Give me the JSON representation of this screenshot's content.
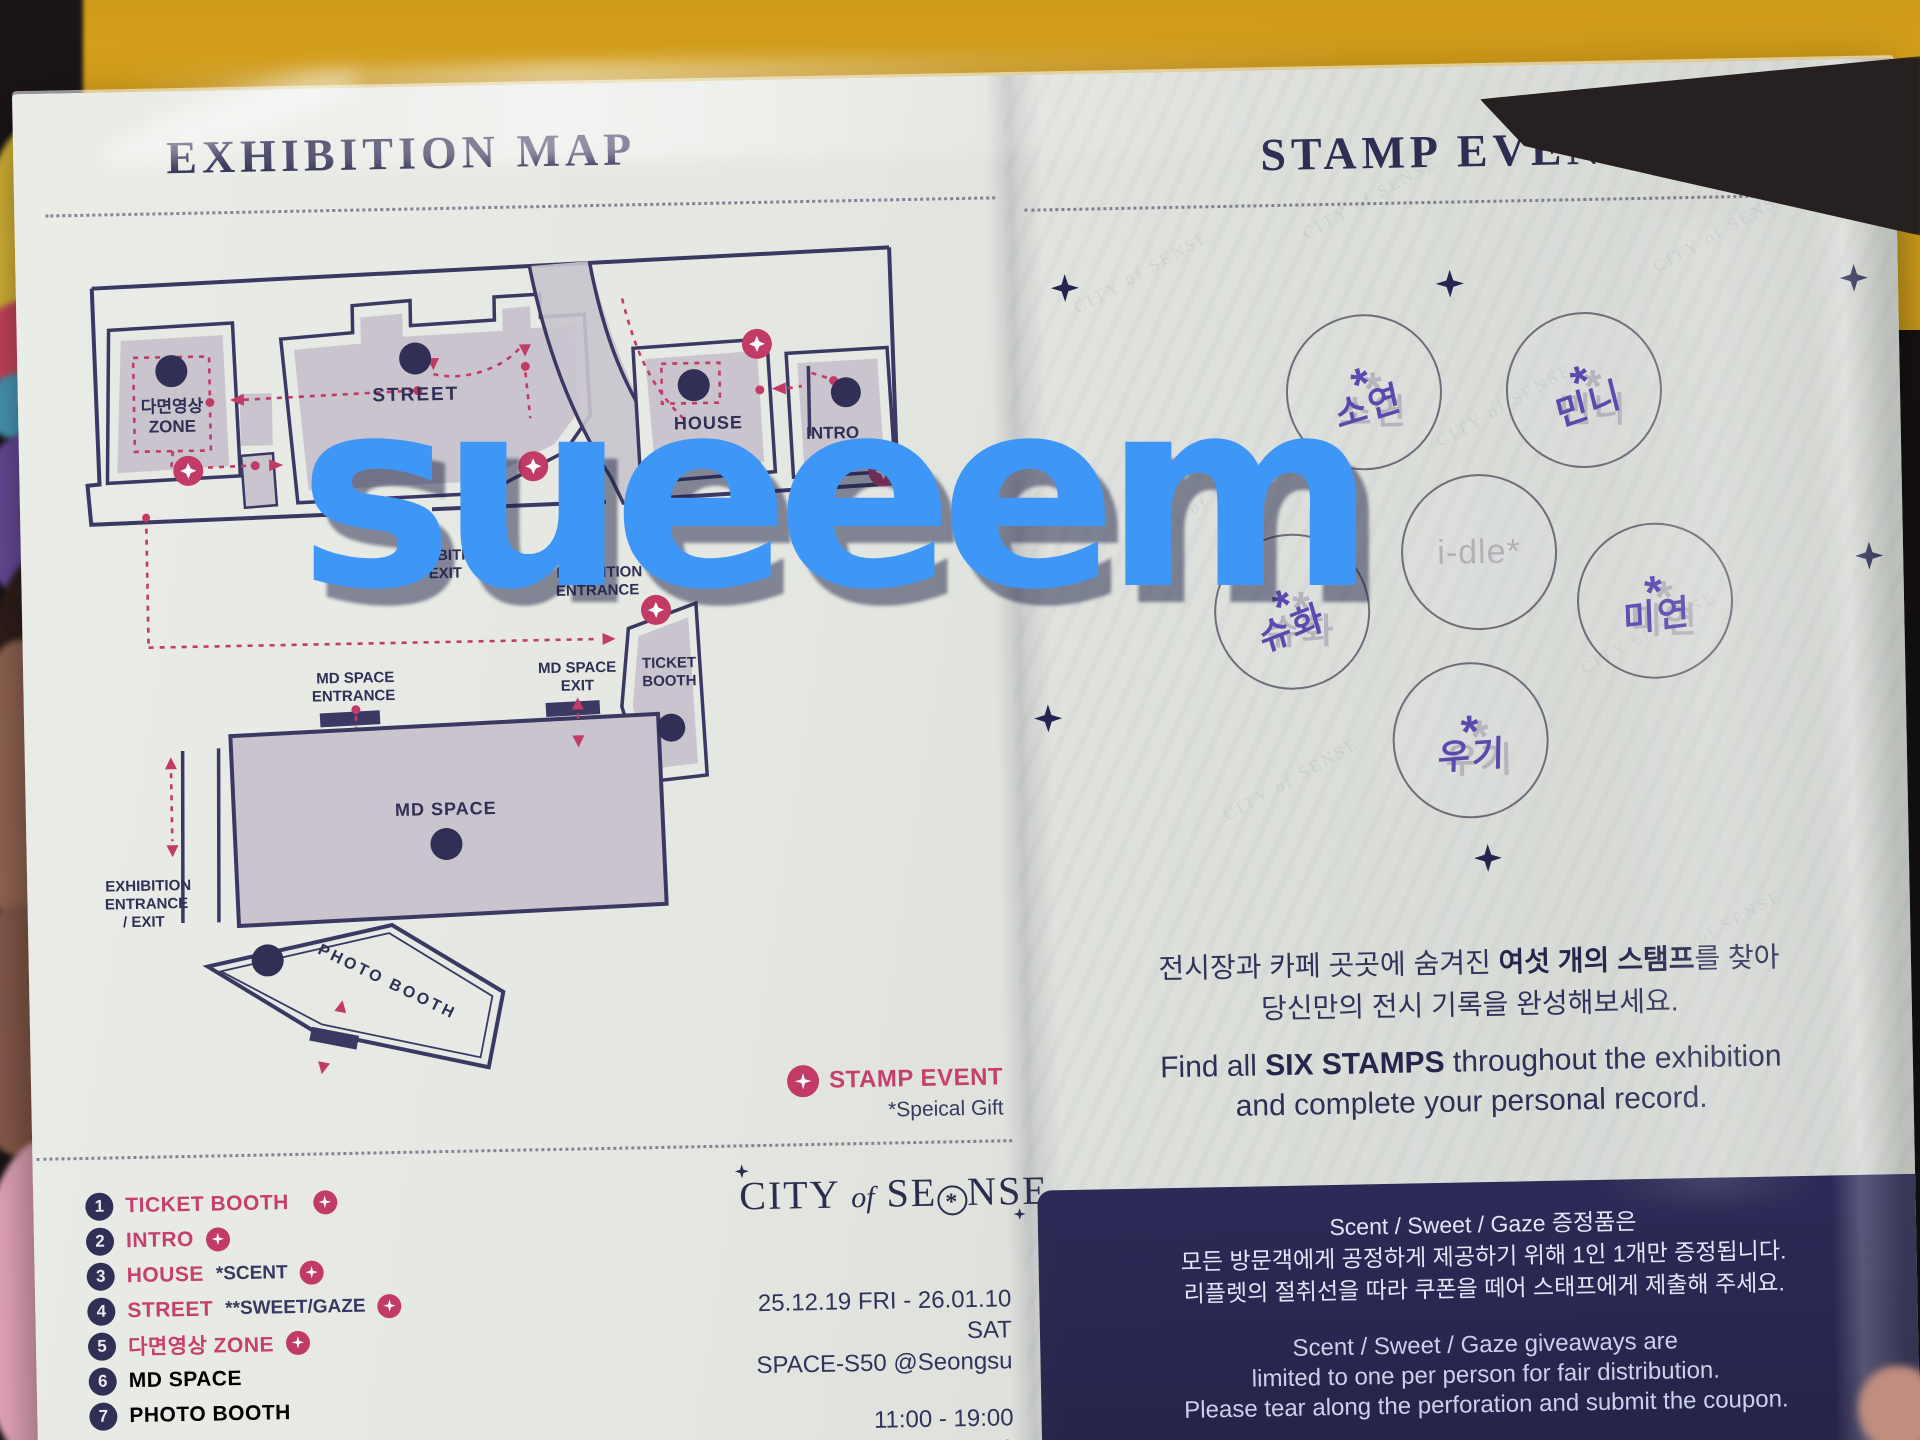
{
  "watermark": "sueeem",
  "background_text": "CITY of SENSE",
  "left_page": {
    "title": "EXHIBITION MAP",
    "map": {
      "zone5_num": "5",
      "zone5_label_1": "다면영상",
      "zone5_label_2": "ZONE",
      "zone4_num": "4",
      "zone4_label": "STREET",
      "zone3_num": "3",
      "zone3_label": "HOUSE",
      "zone2_num": "2",
      "zone2_label": "INTRO",
      "ticket_num": "1",
      "ticket_label_1": "TICKET",
      "ticket_label_2": "BOOTH",
      "md_num": "6",
      "md_label": "MD SPACE",
      "photo_num": "7",
      "photo_label": "PHOTO BOOTH",
      "exit_label_1": "EXHIBITION",
      "exit_label_2": "EXIT",
      "entrance_label_1": "EXHIBITION",
      "entrance_label_2": "ENTRANCE",
      "md_entrance_1": "MD SPACE",
      "md_entrance_2": "ENTRANCE",
      "md_exit_1": "MD SPACE",
      "md_exit_2": "EXIT",
      "main_entrance_1": "EXHIBITION",
      "main_entrance_2": "ENTRANCE",
      "main_entrance_3": "/ EXIT"
    },
    "legend": [
      {
        "num": "1",
        "name": "TICKET BOOTH",
        "note": ""
      },
      {
        "num": "2",
        "name": "INTRO",
        "note": ""
      },
      {
        "num": "3",
        "name": "HOUSE",
        "note": "*SCENT"
      },
      {
        "num": "4",
        "name": "STREET",
        "note": "**SWEET/GAZE"
      },
      {
        "num": "5",
        "name": "다면영상 ZONE",
        "note": ""
      },
      {
        "num": "6",
        "name": "MD SPACE",
        "note": ""
      },
      {
        "num": "7",
        "name": "PHOTO BOOTH",
        "note": ""
      }
    ],
    "stamp_note": {
      "label": "STAMP EVENT",
      "gift": "*Speical Gift"
    },
    "logo": {
      "part1": "CITY",
      "part2": "of",
      "part3": "SE",
      "asterisk": "*",
      "part4": "NSE"
    },
    "schedule": {
      "dates": "25.12.19 FRI - 26.01.10 SAT",
      "venue": "SPACE-S50 @Seongsu",
      "hours": "11:00 - 19:00",
      "hours_note": "(No Break time)",
      "hours_kr": "평일, 주말, 공휴일 동일"
    }
  },
  "right_page": {
    "title": "STAMP EVENT",
    "stamps": [
      {
        "name": "소연"
      },
      {
        "name": "민니"
      },
      {
        "name": "슈화"
      },
      {
        "name": "i-dle*"
      },
      {
        "name": "미연"
      },
      {
        "name": "우기"
      }
    ],
    "desc": {
      "kr_1": "전시장과 카페 곳곳에 숨겨진 ",
      "kr_bold": "여섯 개의 스탬프",
      "kr_2": "를 찾아",
      "kr_line2": "당신만의 전시 기록을 완성해보세요.",
      "en_1": "Find all ",
      "en_bold": "SIX STAMPS",
      "en_2": " throughout the exhibition",
      "en_line2": "and complete your personal record."
    },
    "coupon": {
      "kr_1": "Scent / Sweet / Gaze 증정품은",
      "kr_2": "모든 방문객에게 공정하게 제공하기 위해 1인 1개만 증정됩니다.",
      "kr_3": "리플렛의 절취선을 따라 쿠폰을 떼어 스태프에게 제출해 주세요.",
      "en_1": "Scent / Sweet / Gaze giveaways are",
      "en_2": "limited to one per person for fair distribution.",
      "en_3": "Please tear along the perforation and submit the coupon."
    }
  }
}
